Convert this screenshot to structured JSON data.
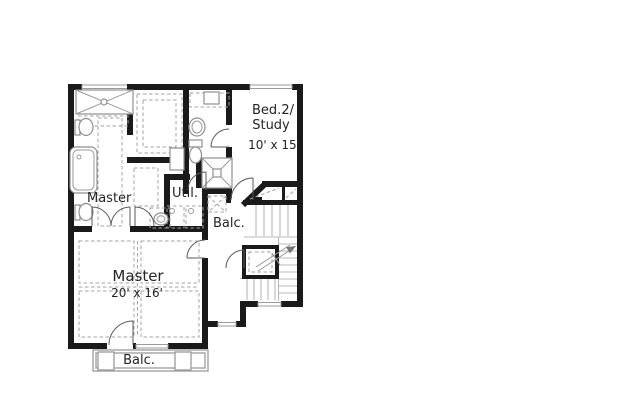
{
  "plan": {
    "labels": {
      "bed2_line1": "Bed.2/",
      "bed2_line2": "Study",
      "bed2_dims": "10' x 15'",
      "master_bath": "Master",
      "utility": "Util.",
      "hall_balcony": "Balc.",
      "master_bedroom": "Master",
      "master_bedroom_dims": "20' x 16'",
      "rear_balcony": "Balc."
    },
    "colors": {
      "wall": "#1a1a1a",
      "fixture_line": "#8f8f8f",
      "dash_line": "#a3a3a3",
      "door_line": "#5a5a5a",
      "stair_line": "#b8b8b8",
      "window_line": "#9a9a9a",
      "text": "#242424",
      "background": "#ffffff"
    }
  }
}
